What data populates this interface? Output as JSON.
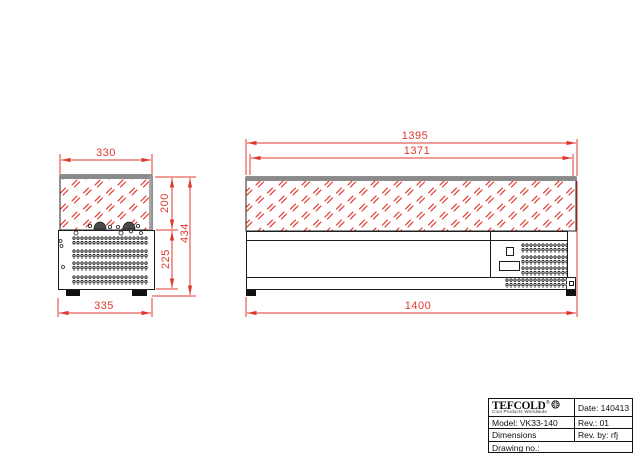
{
  "colors": {
    "dimension_red": "#e0382e",
    "geometry_black": "#1c1c1c",
    "glass_strip_gray": "#8a8a8a"
  },
  "dimensions": {
    "side_view": {
      "glass_width": "330",
      "base_width": "335",
      "glass_height": "200",
      "body_height": "225",
      "total_height": "434"
    },
    "front_view": {
      "glass_width": "1395",
      "glass_inner_width": "1371",
      "total_width": "1400"
    }
  },
  "title_block": {
    "logo_name": "TEFCOLD",
    "logo_reg": "®",
    "logo_tagline": "Cool Products Worldwide",
    "date": "Date: 140413",
    "model": "Model: VK33-140",
    "rev": "Rev.: 01",
    "dimensions_label": "Dimensions",
    "rev_by": "Rev. by: rfj",
    "drawing_no": "Drawing no.:"
  }
}
